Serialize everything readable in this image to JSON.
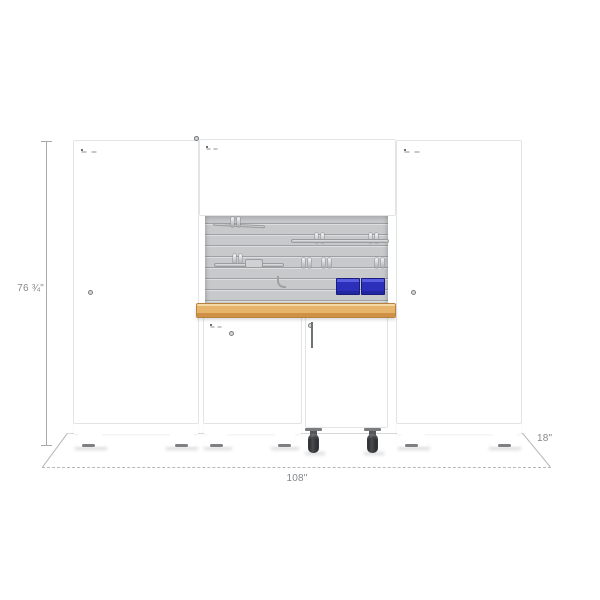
{
  "diagram": {
    "type": "product-dimension-diagram",
    "subject": "modular garage cabinet set with workbench",
    "dimension_labels": {
      "height": "76 ¾\"",
      "width": "108\"",
      "depth": "18\""
    },
    "components": [
      {
        "id": "locker-cabinet-left",
        "label": "tall 2-door locker cabinet"
      },
      {
        "id": "wall-cabinet-left",
        "label": "2-door wall cabinet"
      },
      {
        "id": "wall-cabinet-right",
        "label": "2-door wall cabinet"
      },
      {
        "id": "slatwall-panel",
        "label": "slatwall back panel with hooks and tools"
      },
      {
        "id": "storage-bins",
        "label": "two blue storage bins"
      },
      {
        "id": "workbench-top",
        "label": "wood workbench top"
      },
      {
        "id": "base-cabinet",
        "label": "2-door base cabinet"
      },
      {
        "id": "tool-cart",
        "label": "rolling tool drawer cabinet on casters"
      },
      {
        "id": "locker-cabinet-right",
        "label": "tall 2-door locker cabinet"
      }
    ],
    "colors": {
      "door_gray": "#8b8e91",
      "frame_white": "#ffffff",
      "slatwall_gray": "#c7c9cb",
      "bench_wood": "#e7b46b",
      "bin_blue": "#2b2fb9",
      "caster_black": "#2a2b2d",
      "dimension_line": "#a8aaac",
      "dimension_text": "#85878a"
    }
  }
}
